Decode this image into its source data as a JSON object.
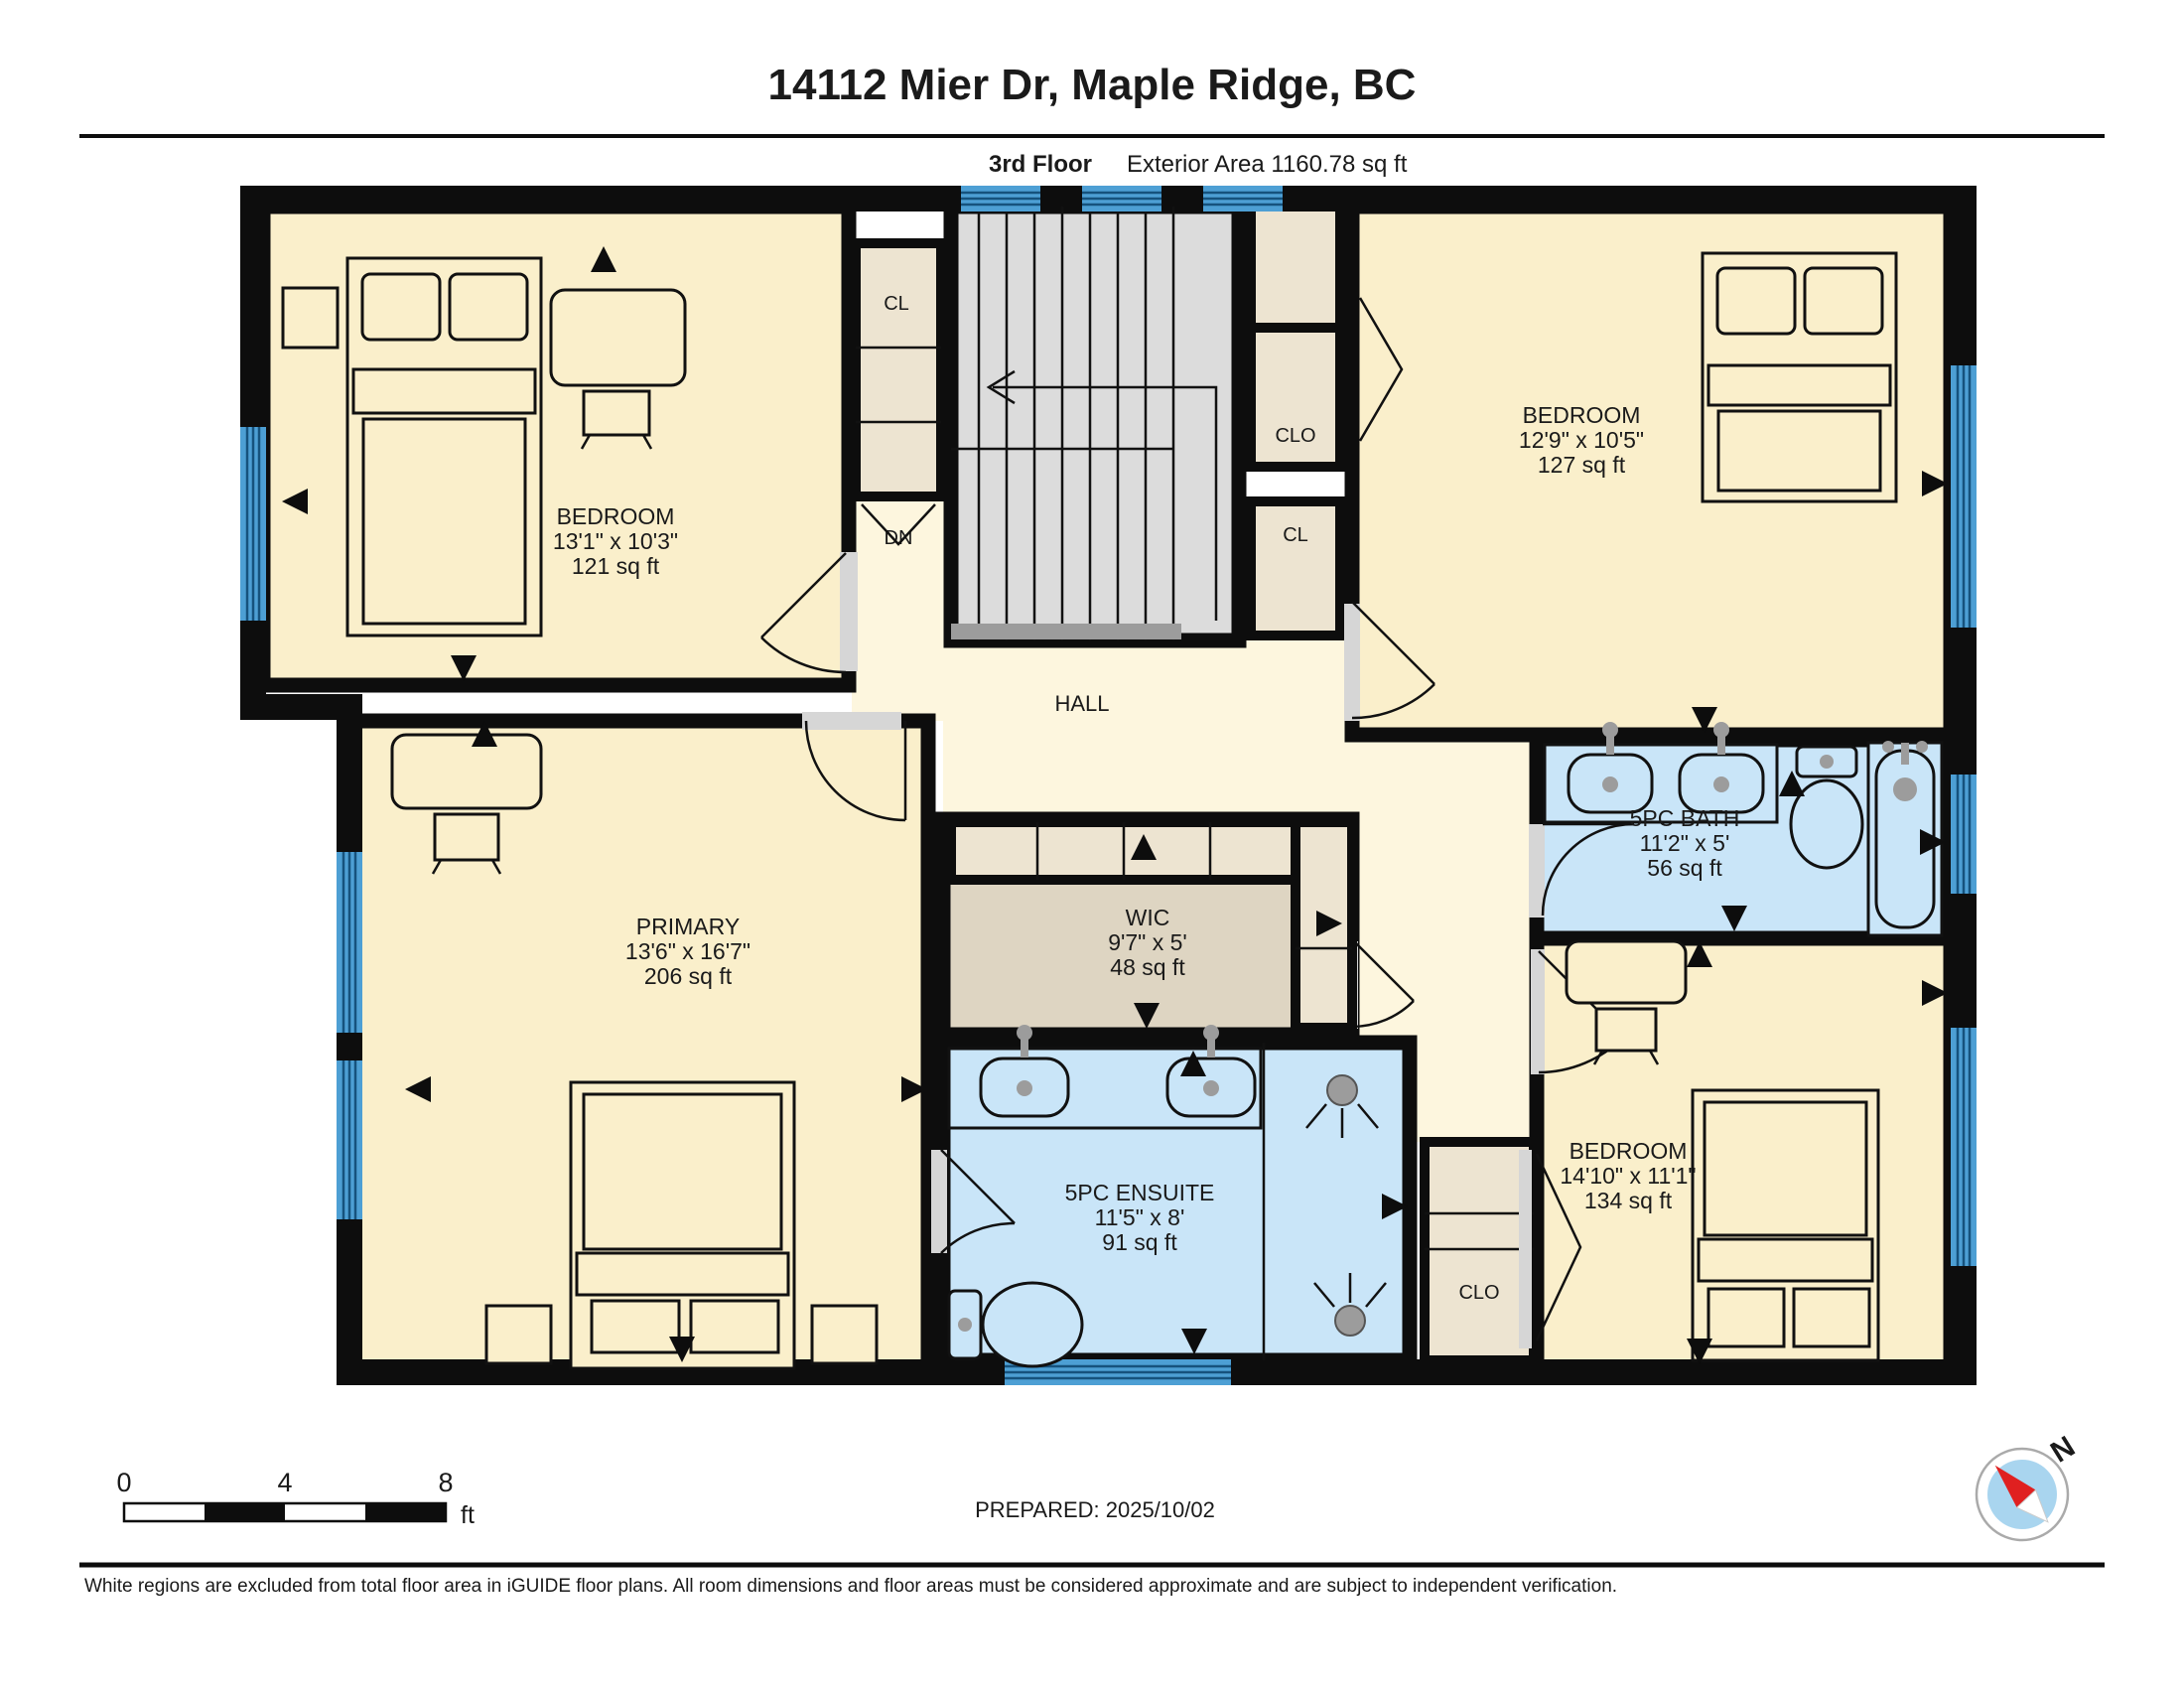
{
  "header": {
    "title": "14112 Mier Dr, Maple Ridge, BC",
    "floor_label": "3rd Floor",
    "area_label": "Exterior Area 1160.78 sq ft"
  },
  "rooms": {
    "bedroom_tl": {
      "name": "BEDROOM",
      "dims": "13'1\" x 10'3\"",
      "area": "121 sq ft"
    },
    "bedroom_tr": {
      "name": "BEDROOM",
      "dims": "12'9\" x 10'5\"",
      "area": "127 sq ft"
    },
    "bath": {
      "name": "5PC BATH",
      "dims": "11'2\" x 5'",
      "area": "56 sq ft"
    },
    "primary": {
      "name": "PRIMARY",
      "dims": "13'6\" x 16'7\"",
      "area": "206 sq ft"
    },
    "wic": {
      "name": "WIC",
      "dims": "9'7\" x 5'",
      "area": "48 sq ft"
    },
    "ensuite": {
      "name": "5PC ENSUITE",
      "dims": "11'5\" x 8'",
      "area": "91 sq ft"
    },
    "bedroom_br": {
      "name": "BEDROOM",
      "dims": "14'10\" x 11'1\"",
      "area": "134 sq ft"
    },
    "hall": {
      "name": "HALL"
    }
  },
  "labels": {
    "stairs_down": "DN",
    "closet_tl": "CL",
    "closet_tr_clo": "CLO",
    "closet_tr_cl": "CL",
    "closet_br": "CLO"
  },
  "scale_bar": {
    "tick_0": "0",
    "tick_4": "4",
    "tick_8": "8",
    "unit": "ft"
  },
  "compass": {
    "north": "N"
  },
  "footer": {
    "prepared": "PREPARED: 2025/10/02",
    "disclaimer": "White regions are excluded from total floor area in iGUIDE floor plans. All room dimensions and floor areas must be considered approximate and are subject to independent verification."
  },
  "colors": {
    "room_fill": "#FAEFCB",
    "hall_fill": "#FDF6DE",
    "closet_fill": "#EDE4D1",
    "wic_fill": "#DED5C2",
    "stair_fill": "#DCDCDC",
    "bath_fill": "#C9E5F8",
    "window_blue": "#4D9FD4",
    "wall": "#0d0d0d",
    "compass_red": "#E02020"
  }
}
